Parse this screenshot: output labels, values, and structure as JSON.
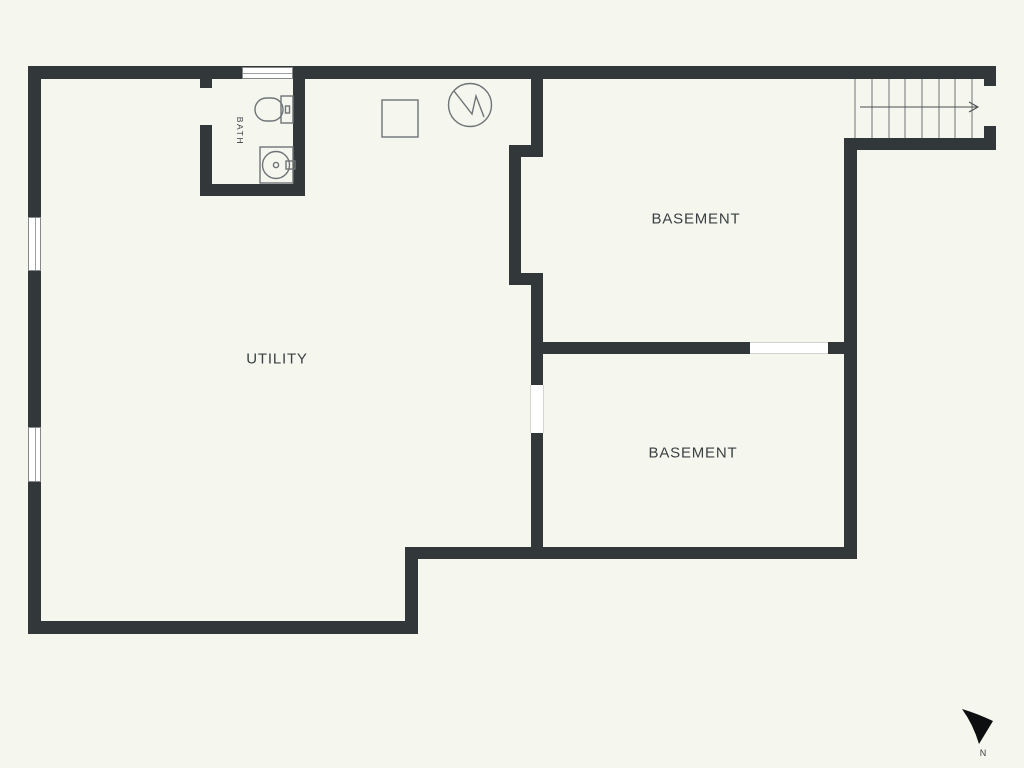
{
  "colors": {
    "background": "#f5f6ee",
    "wall": "#32373a",
    "label": "#3a4043",
    "outline": "#6f7477",
    "window": "#ffffff",
    "compass": "#0c0e0f"
  },
  "rooms": [
    {
      "label": "UTILITY"
    },
    {
      "label": "BASEMENT"
    },
    {
      "label": "BASEMENT"
    },
    {
      "label": "BATH"
    }
  ],
  "compass": {
    "label": "N"
  },
  "fixtures": {
    "stairs": "stairs-with-up-direction-arrow",
    "toilet": "toilet-icon",
    "sink": "vanity-sink-icon",
    "appliance": "square-appliance-icon",
    "water_heater": "water-heater-circle-icon",
    "windows": "window-symbol",
    "doors": "door-opening-symbol"
  }
}
